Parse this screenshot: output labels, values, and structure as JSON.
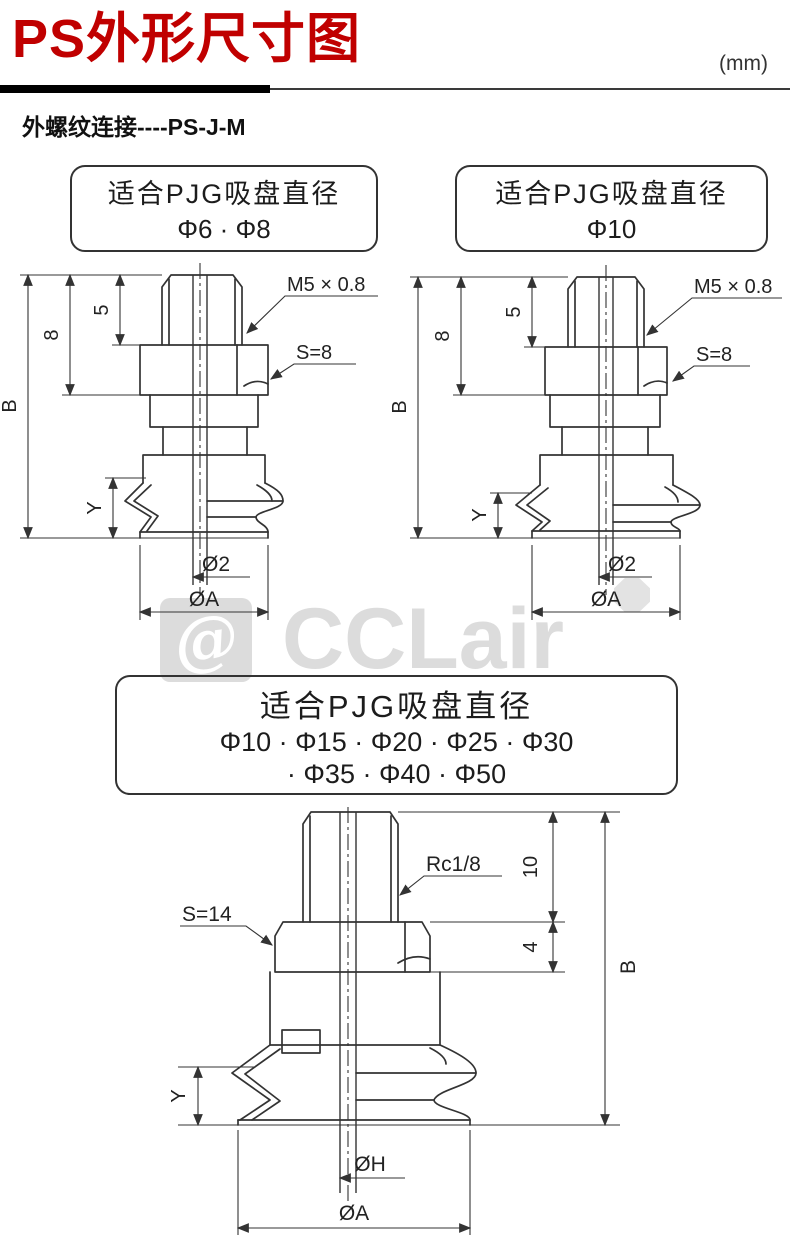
{
  "header": {
    "title": "PS外形尺寸图",
    "unit": "(mm)",
    "subtitle": "外螺纹连接----PS-J-M"
  },
  "watermark": {
    "symbol": "@",
    "brand": "CCLair"
  },
  "colors": {
    "accent": "#c00000",
    "line": "#333333",
    "watermark": "#dcdcdc"
  },
  "figures": {
    "fig1": {
      "caption": {
        "line1": "适合PJG吸盘直径",
        "line2": "Φ6 · Φ8"
      },
      "labels": {
        "thread": "M5 × 0.8",
        "wrench": "S=8",
        "total_height": "B",
        "dim8": "8",
        "dim5": "5",
        "dimY": "Y",
        "bore": "Ø2",
        "outer": "ØA"
      }
    },
    "fig2": {
      "caption": {
        "line1": "适合PJG吸盘直径",
        "line2": "Φ10"
      },
      "labels": {
        "thread": "M5 × 0.8",
        "wrench": "S=8",
        "total_height": "B",
        "dim8": "8",
        "dim5": "5",
        "dimY": "Y",
        "bore": "Ø2",
        "outer": "ØA"
      }
    },
    "fig3": {
      "caption": {
        "line1": "适合PJG吸盘直径",
        "line2": "Φ10 · Φ15 · Φ20 · Φ25 · Φ30",
        "line3": "· Φ35 · Φ40 · Φ50"
      },
      "labels": {
        "thread": "Rc1/8",
        "wrench": "S=14",
        "total_height": "B",
        "dim10": "10",
        "dim4": "4",
        "dimY": "Y",
        "bore": "ØH",
        "outer": "ØA"
      }
    }
  }
}
